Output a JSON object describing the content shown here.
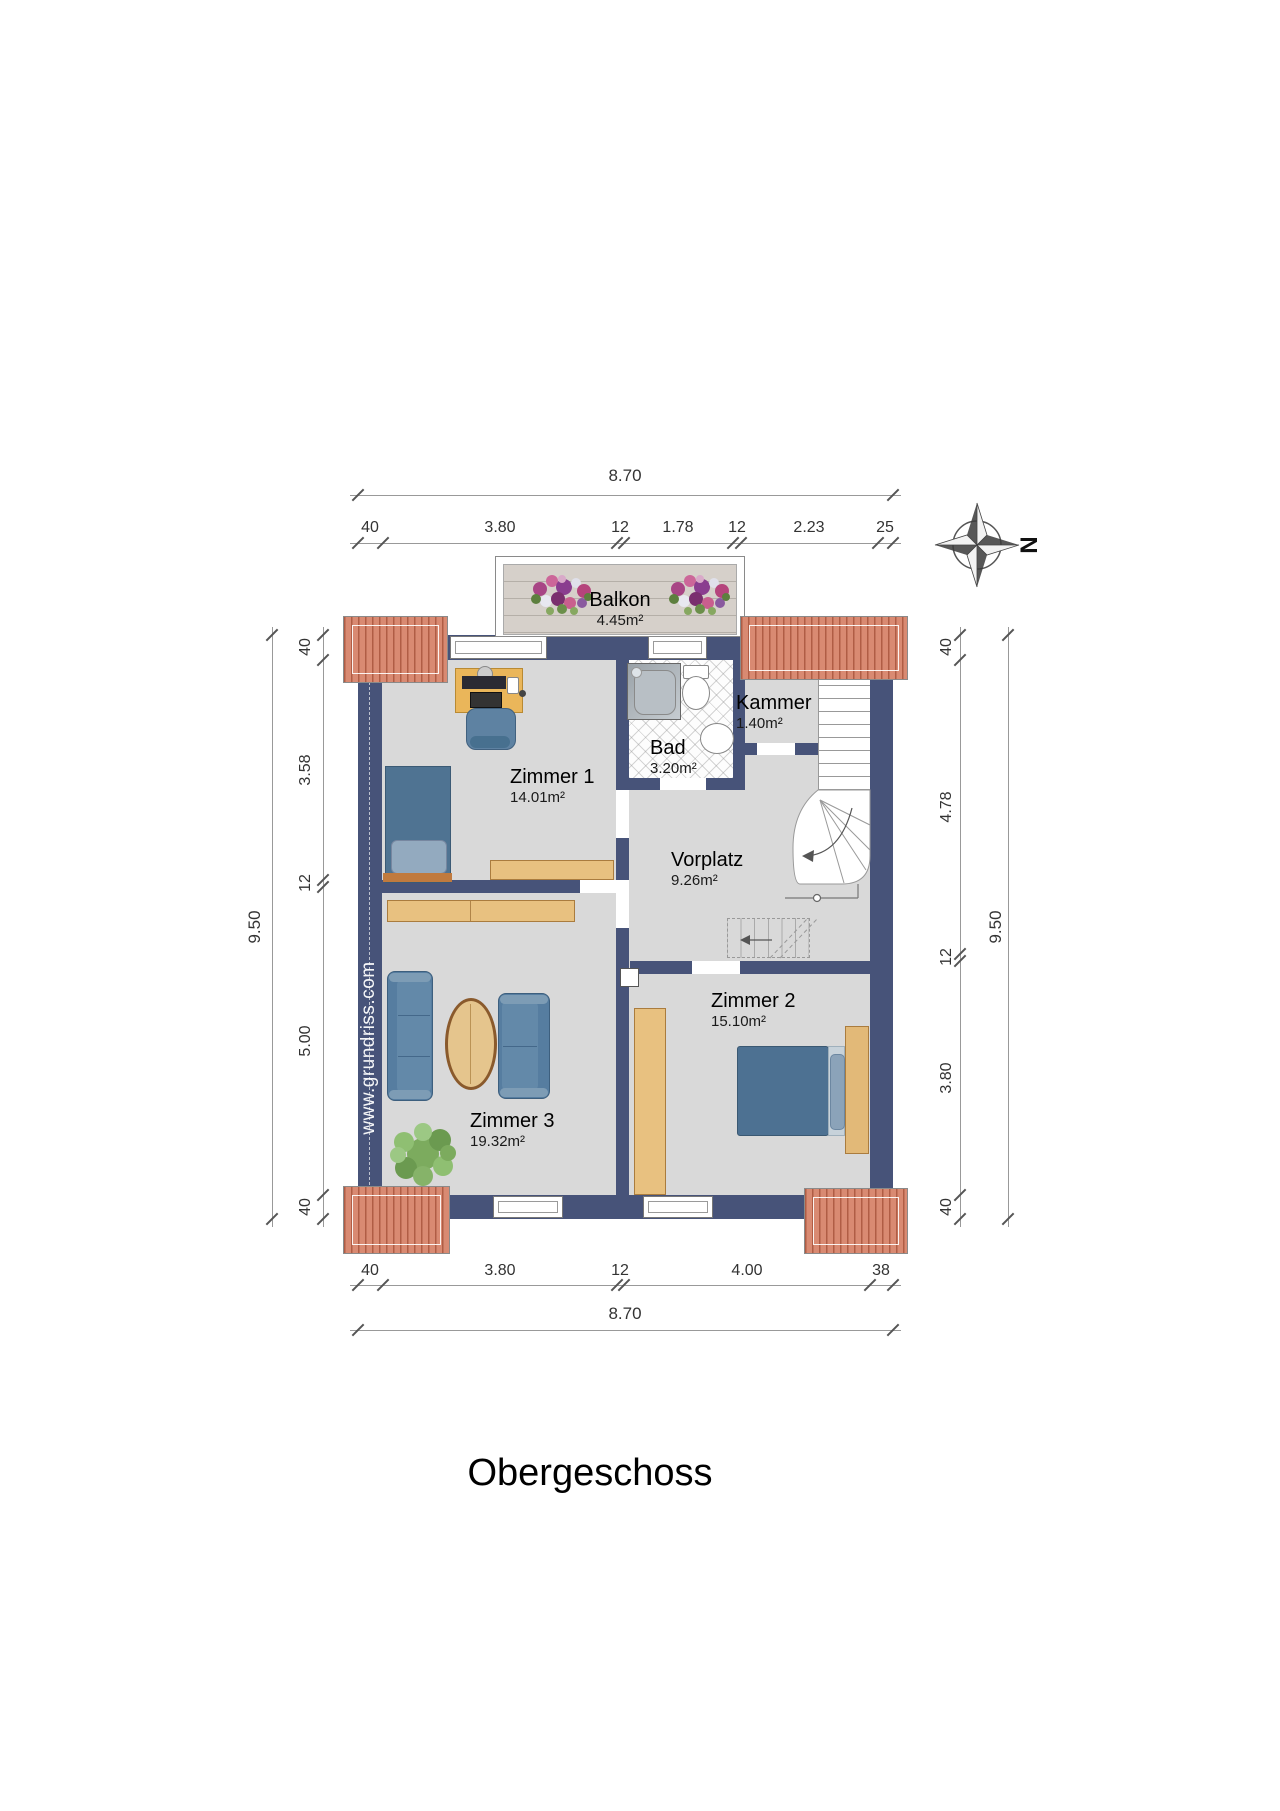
{
  "title": "Obergeschoss",
  "watermark": "www.grundriss.com",
  "compass": {
    "label": "N"
  },
  "rooms": {
    "balkon": {
      "name": "Balkon",
      "area": "4.45m²"
    },
    "zimmer1": {
      "name": "Zimmer 1",
      "area": "14.01m²"
    },
    "bad": {
      "name": "Bad",
      "area": "3.20m²"
    },
    "kammer": {
      "name": "Kammer",
      "area": "1.40m²"
    },
    "vorplatz": {
      "name": "Vorplatz",
      "area": "9.26m²"
    },
    "zimmer2": {
      "name": "Zimmer 2",
      "area": "15.10m²"
    },
    "zimmer3": {
      "name": "Zimmer 3",
      "area": "19.32m²"
    }
  },
  "dimensions": {
    "top": {
      "overall": "8.70",
      "segments": [
        "40",
        "3.80",
        "12",
        "1.78",
        "12",
        "2.23",
        "25"
      ]
    },
    "bottom": {
      "overall": "8.70",
      "segments": [
        "40",
        "3.80",
        "12",
        "4.00",
        "38"
      ]
    },
    "left": {
      "overall": "9.50",
      "segments": [
        "40",
        "3.58",
        "12",
        "5.00",
        "40"
      ]
    },
    "right": {
      "overall": "9.50",
      "segments": [
        "40",
        "4.78",
        "12",
        "3.80",
        "40"
      ]
    }
  },
  "colors": {
    "wall": "#475379",
    "roof": "#d98a72",
    "floor": "#d9d9d9",
    "wood": "#e8c180",
    "furniture_blue": "#567da0",
    "deck": "#d6d0ca"
  }
}
